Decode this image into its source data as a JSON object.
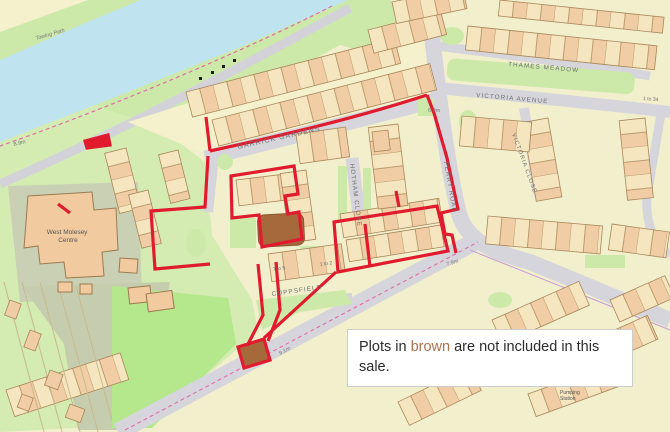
{
  "note": {
    "part1": "Plots in ",
    "highlight": "brown",
    "part2": " are not included in this sale.",
    "highlight_color": "#b0714d"
  },
  "map": {
    "street_labels": [
      {
        "id": "garrick-gardens",
        "text": "GARRICK GARDENS"
      },
      {
        "id": "hotham-close",
        "text": "HOTHAM CLOSE"
      },
      {
        "id": "ferry-road",
        "text": "FERRY ROAD"
      },
      {
        "id": "victoria-close",
        "text": "VICTORIA CLOSE"
      },
      {
        "id": "thames-meadow",
        "text": "THAMES MEADOW"
      },
      {
        "id": "victoria-avenue",
        "text": "VICTORIA AVENUE"
      },
      {
        "id": "coppsfield",
        "text": "COPPSFIELD"
      },
      {
        "id": "towing-path",
        "text": "Towing Path"
      }
    ],
    "place_labels": [
      {
        "id": "west-molesey-centre",
        "line1": "West Molesey",
        "line2": "Centre"
      },
      {
        "id": "pumping-station",
        "line1": "Pumping",
        "line2": "Station"
      }
    ],
    "spot_heights": [
      {
        "text": "8.9m"
      },
      {
        "text": "6.9m"
      },
      {
        "text": "7.9m"
      },
      {
        "text": "9.1m"
      }
    ],
    "plot_labels": [
      {
        "text": "7 to 5"
      },
      {
        "text": "1 to 2"
      },
      {
        "text": "1 to 34"
      }
    ],
    "colors": {
      "boundary_red": "#e11b2e",
      "excluded_brown": "#a5693c",
      "water_blue": "#bfe3ef",
      "bank_green": "#cde9a9",
      "road_grey": "#d6d5dc"
    }
  }
}
